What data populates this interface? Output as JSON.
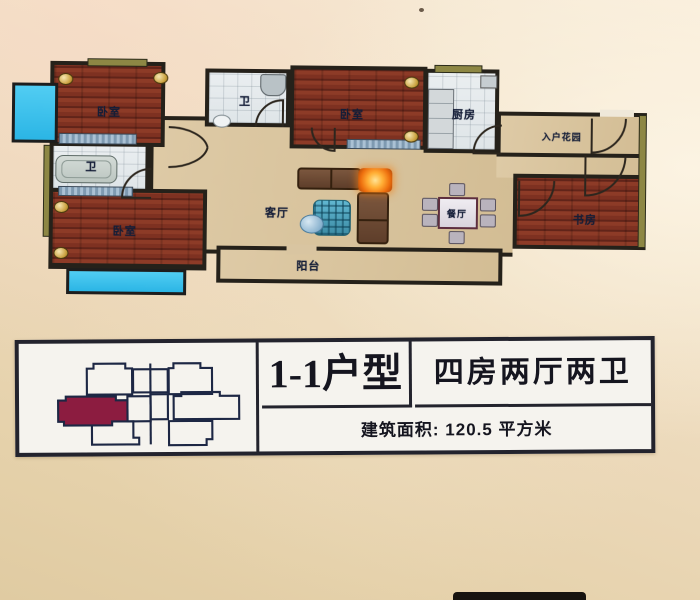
{
  "photo": {
    "bg_top": "#f7ead7",
    "bg_bottom": "#e2cea6"
  },
  "plan": {
    "labels": {
      "bedroom_tl": "卧室",
      "bath_left": "卫",
      "bedroom_bl": "卧室",
      "bath_mid": "卫",
      "bedroom_tr": "卧室",
      "kitchen": "厨房",
      "entry_garden": "入户花园",
      "study": "书房",
      "living": "客厅",
      "dining": "餐厅",
      "balcony": "阳台"
    },
    "colors": {
      "wall": "#25211a",
      "wood_floor": "#7c3422",
      "hall_floor": "#d8c5a2",
      "window_glass": "#45c4ec",
      "window_frame": "#8d8746",
      "bed": "#c6d3dd",
      "lamp_glow": "#f08018"
    }
  },
  "info_panel": {
    "unit_type": "1-1户型",
    "rooms_summary": "四房两厅两卫",
    "area": "建筑面积: 120.5 平方米",
    "highlight_color": "#8c1c40"
  }
}
